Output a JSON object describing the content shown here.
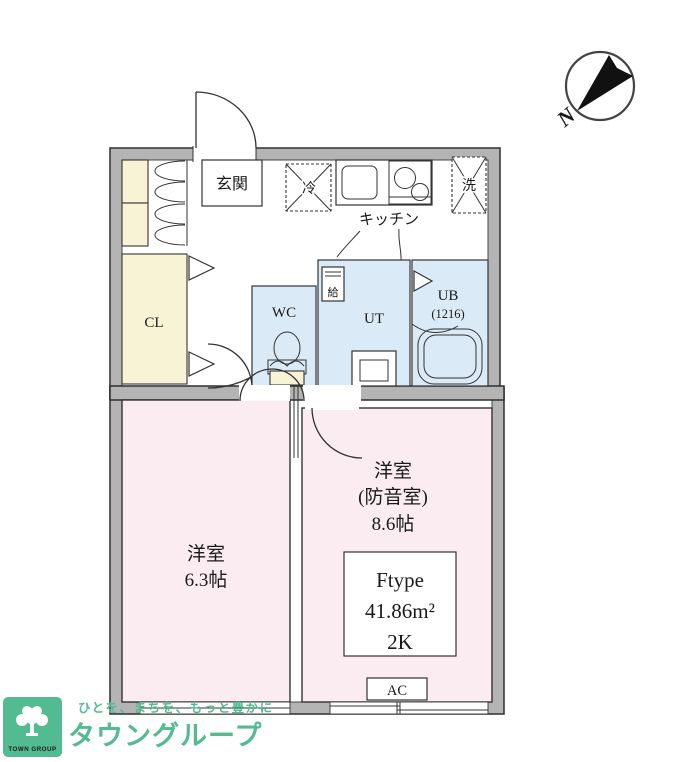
{
  "compass": {
    "north": "N"
  },
  "rooms": {
    "entrance": "玄関",
    "fridge": "冷",
    "washer": "洗",
    "kitchen": "キッチン",
    "closet": "CL",
    "wc": "WC",
    "utility": "UT",
    "water_heater": "給",
    "bath_line1": "UB",
    "bath_line2": "(1216)",
    "bedroom_left": {
      "line1": "洋室",
      "line2": "6.3帖"
    },
    "bedroom_right": {
      "line1": "洋室",
      "line2": "(防音室)",
      "line3": "8.6帖"
    },
    "ac": "AC"
  },
  "unit_info": {
    "type": "Ftype",
    "area": "41.86m²",
    "layout": "2K"
  },
  "logo": {
    "square_text": "TOWN GROUP",
    "slogan": "ひとを、まちを、もっと豊かに",
    "brand": "タウングループ"
  },
  "colors": {
    "wall": "#b4b4b4",
    "room_pink": "#fbecf1",
    "wet_blue": "#daeaf6",
    "closet_cream": "#f8f3d4",
    "brand_green": "#53bb92"
  }
}
